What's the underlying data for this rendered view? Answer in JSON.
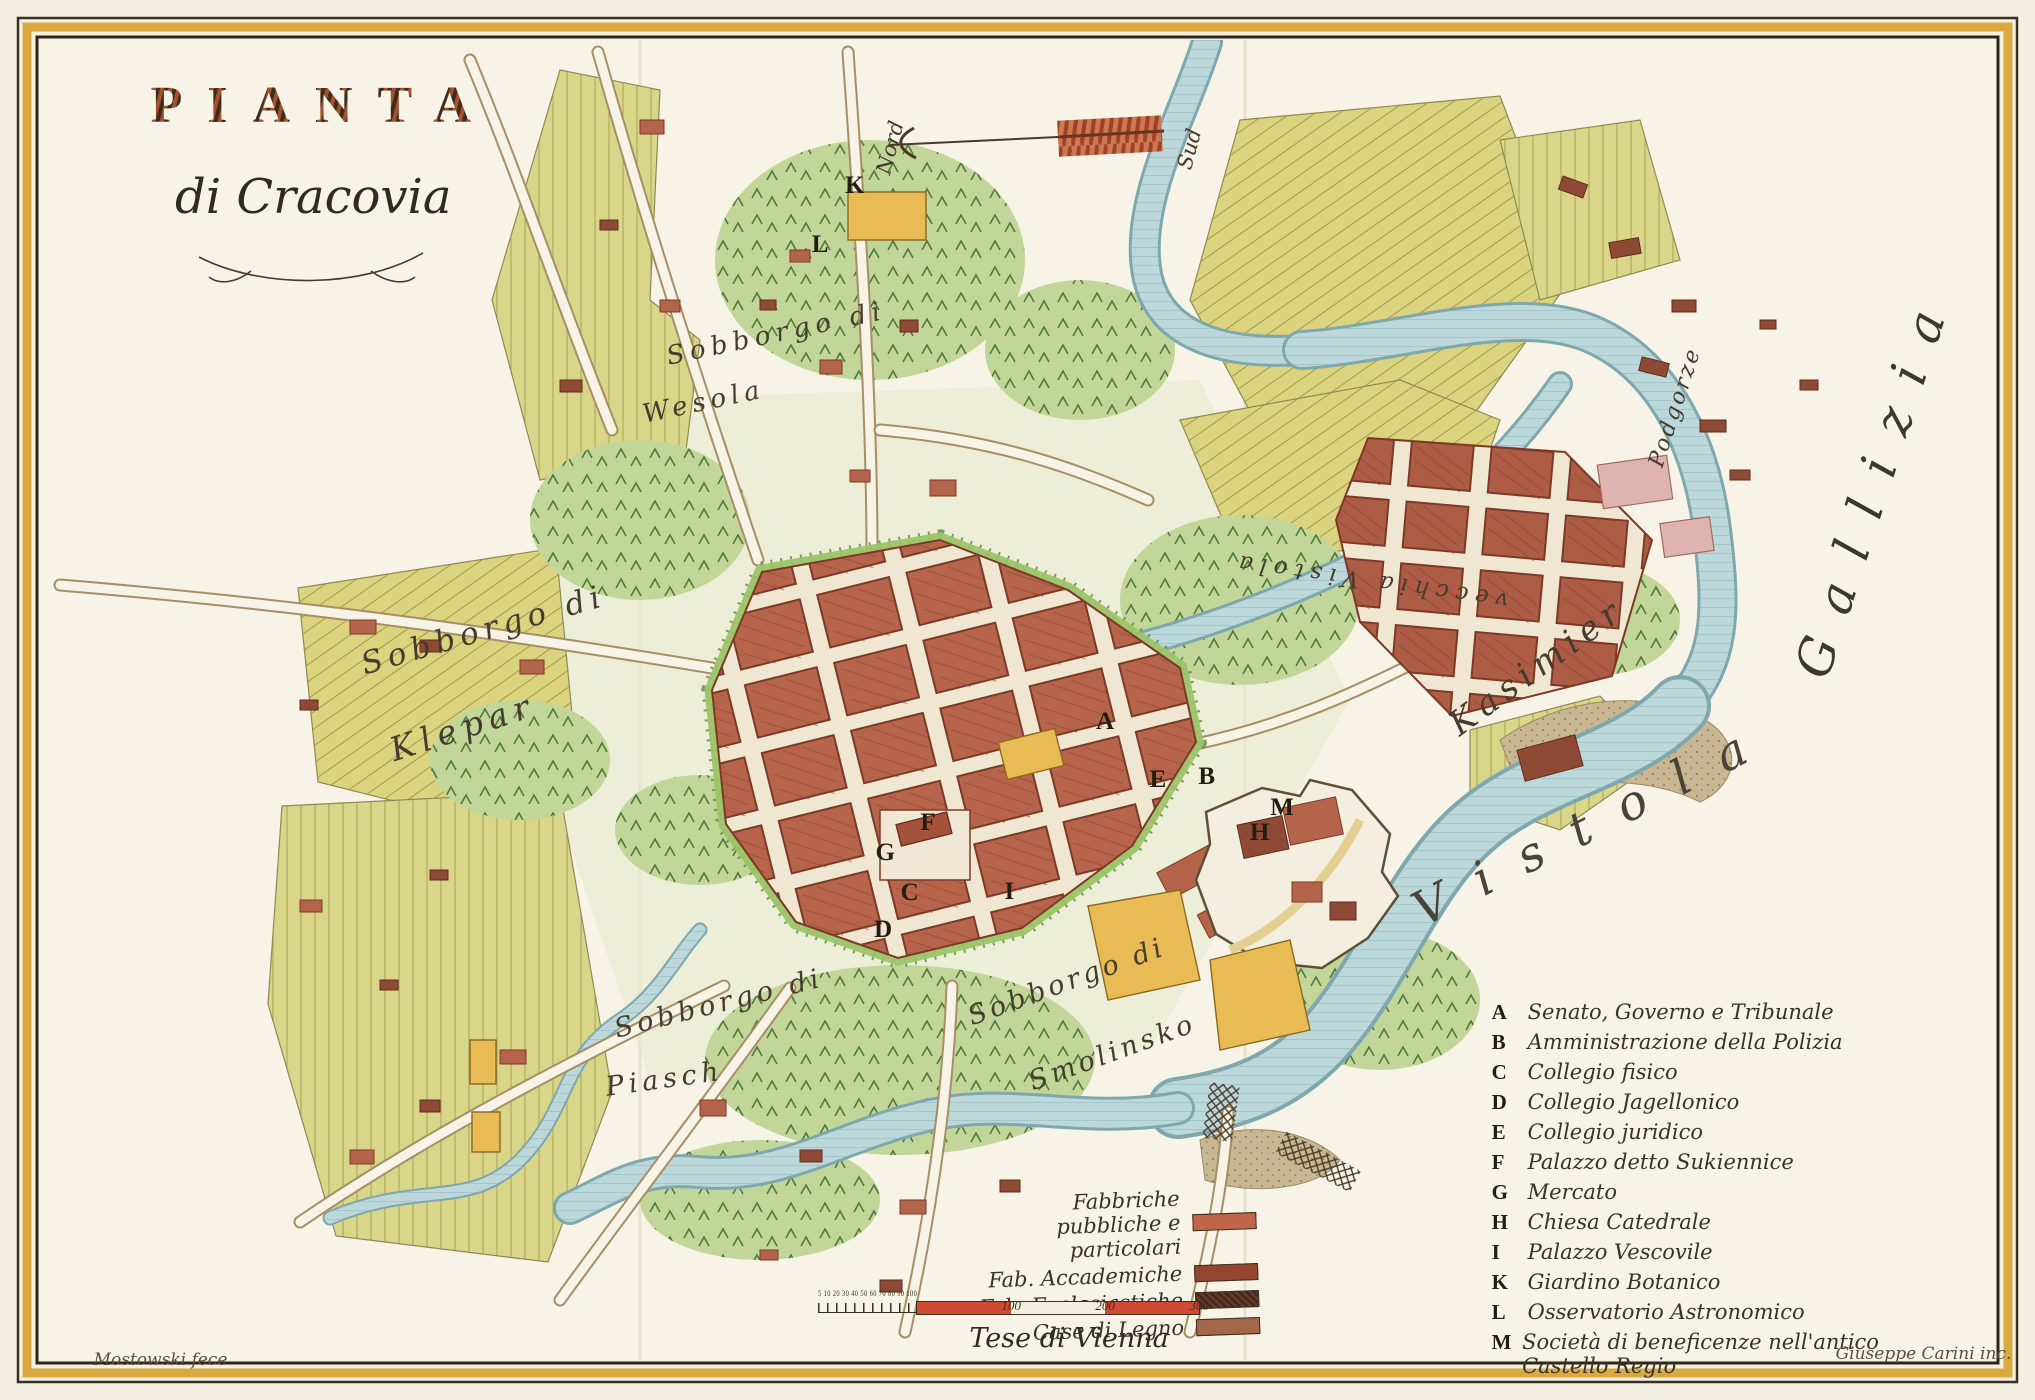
{
  "title": {
    "main": "PIANTA",
    "sub": "di Cracovia"
  },
  "compass": {
    "north": "Nord",
    "south": "Sud"
  },
  "map_labels": {
    "wesola_line1": "Sobborgo di",
    "wesola_line2": "Wesola",
    "klepar_line1": "Sobborgo di",
    "klepar_line2": "Klepar",
    "piasek_line1": "Sobborgo di",
    "piasek_line2": "Piasch",
    "smolensko_line1": "Sobborgo di",
    "smolensko_line2": "Smolinsko",
    "kasimir": "Kasimier",
    "podgorze": "Podgorze",
    "vistola": "Vistola",
    "vecchia_vistola": "vecchia Vistola",
    "gallizia": "Gallizia"
  },
  "markers": [
    {
      "letter": "A",
      "x": 54.3,
      "y": 51.6
    },
    {
      "letter": "B",
      "x": 59.3,
      "y": 55.5
    },
    {
      "letter": "C",
      "x": 44.7,
      "y": 63.8
    },
    {
      "letter": "D",
      "x": 43.4,
      "y": 66.4
    },
    {
      "letter": "E",
      "x": 56.9,
      "y": 55.7
    },
    {
      "letter": "F",
      "x": 45.6,
      "y": 58.8
    },
    {
      "letter": "G",
      "x": 43.5,
      "y": 60.9
    },
    {
      "letter": "H",
      "x": 61.9,
      "y": 59.5
    },
    {
      "letter": "I",
      "x": 49.6,
      "y": 63.7
    },
    {
      "letter": "K",
      "x": 42.0,
      "y": 13.3
    },
    {
      "letter": "L",
      "x": 40.3,
      "y": 17.5
    },
    {
      "letter": "M",
      "x": 63.0,
      "y": 57.7
    }
  ],
  "legend": {
    "items": [
      {
        "letter": "A",
        "label": "Senato, Governo e Tribunale"
      },
      {
        "letter": "B",
        "label": "Amministrazione della Polizia"
      },
      {
        "letter": "C",
        "label": "Collegio fisico"
      },
      {
        "letter": "D",
        "label": "Collegio Jagellonico"
      },
      {
        "letter": "E",
        "label": "Collegio juridico"
      },
      {
        "letter": "F",
        "label": "Palazzo detto Sukiennice"
      },
      {
        "letter": "G",
        "label": "Mercato"
      },
      {
        "letter": "H",
        "label": "Chiesa Catedrale"
      },
      {
        "letter": "I",
        "label": "Palazzo Vescovile"
      },
      {
        "letter": "K",
        "label": "Giardino Botanico"
      },
      {
        "letter": "L",
        "label": "Osservatorio Astronomico"
      },
      {
        "letter": "M",
        "label": "Società di beneficenze nell'antico Castello Regio"
      }
    ]
  },
  "key": {
    "rows": [
      {
        "label": "Fabbriche pubbliche e particolari",
        "color": "#c0654a",
        "hatch": false
      },
      {
        "label": "Fab. Accademiche",
        "color": "#93452f",
        "hatch": false
      },
      {
        "label": "Fab. Ecclesiastiche",
        "color": "#63392a",
        "hatch": true
      },
      {
        "label": "Case di Legno",
        "color": "#a5674a",
        "hatch": false
      }
    ]
  },
  "scale": {
    "minor_labels": "5 10 20 30 40 50 60 70 80 90 100",
    "major_labels": [
      "100",
      "200",
      "300"
    ],
    "caption": "Tese di Vienna"
  },
  "credits": {
    "left": "Mostowski fece",
    "right": "Giuseppe Carini inc."
  },
  "colors": {
    "paper": "#f3efe1",
    "frame_gold": "#d9a93f",
    "frame_dark": "#2e2718",
    "river": "#bcd8da",
    "fields": "#d9d68a",
    "city_blocks": "#b6654c",
    "scale_red": "#cf4a32"
  }
}
